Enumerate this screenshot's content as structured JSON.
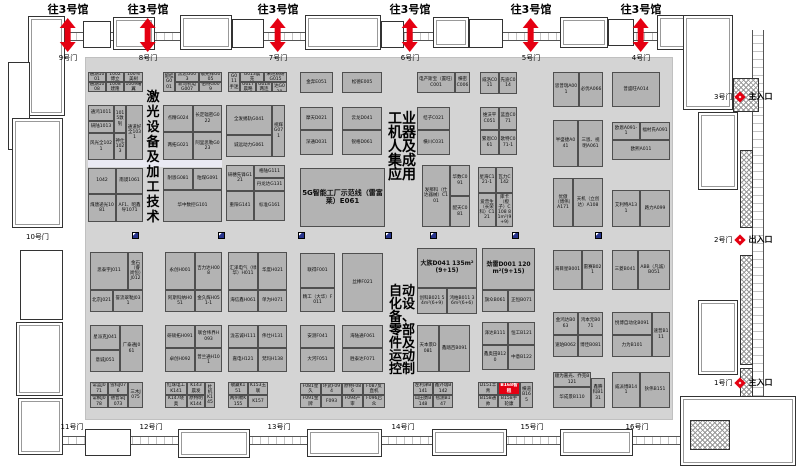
{
  "colors": {
    "hall_bg": "#d4d4d4",
    "booth_bg": "#b3b3b3",
    "booth_border": "#4f4f4f",
    "red": "#e50012",
    "icon_blue": "#27348b"
  },
  "labels": {
    "to_hall3": "往3号馆"
  },
  "top_gates": [
    {
      "label": "9号门",
      "x": 68
    },
    {
      "label": "8号门",
      "x": 148
    },
    {
      "label": "7号门",
      "x": 278
    },
    {
      "label": "6号门",
      "x": 410
    },
    {
      "label": "5号门",
      "x": 531
    },
    {
      "label": "4号门",
      "x": 641
    }
  ],
  "bottom_gates": [
    {
      "label": "11号门",
      "x": 72
    },
    {
      "label": "12号门",
      "x": 151
    },
    {
      "label": "13号门",
      "x": 279
    },
    {
      "label": "14号门",
      "x": 403
    },
    {
      "label": "15号门",
      "x": 532
    },
    {
      "label": "16号门",
      "x": 637
    }
  ],
  "left_gate": {
    "label": "10号门",
    "x": 26,
    "y": 232
  },
  "right_gates": [
    {
      "label": "3号门",
      "y": 91,
      "entrance": "主入口"
    },
    {
      "label": "2号门",
      "y": 234,
      "entrance": "出入口"
    },
    {
      "label": "1号门",
      "y": 377,
      "entrance": "主入口"
    }
  ],
  "hall": {
    "zones": [
      {
        "t": "激光设备及加工技术",
        "x": 145,
        "y": 90,
        "w": 16,
        "fs": 13,
        "lh": 15
      },
      {
        "t": "工业机器人及集成应用",
        "x": 387,
        "y": 112,
        "w": 30,
        "fs": 14,
        "lh": 14
      },
      {
        "t": "自动化设备、零部件及运动控制",
        "x": 388,
        "y": 285,
        "w": 28,
        "fs": 13,
        "lh": 13
      }
    ],
    "facility_icons": {
      "y": 232,
      "x": [
        132,
        218,
        298,
        385,
        430,
        512,
        595
      ]
    },
    "booths": [
      [
        88,
        72,
        18,
        10,
        "通湖1001"
      ],
      [
        106,
        72,
        18,
        10,
        "1002博立"
      ],
      [
        124,
        72,
        19,
        10,
        "100%美树"
      ],
      [
        88,
        82,
        18,
        10,
        "通湖1008"
      ],
      [
        106,
        82,
        18,
        10,
        "1008建隆"
      ],
      [
        124,
        82,
        19,
        10,
        "1009曙翼"
      ],
      [
        163,
        72,
        12,
        20,
        "留桂G001"
      ],
      [
        175,
        72,
        24,
        10,
        "黑思G003"
      ],
      [
        199,
        72,
        23,
        10,
        "敬光拜G005"
      ],
      [
        175,
        82,
        24,
        10,
        "新马机电G007"
      ],
      [
        199,
        82,
        23,
        10,
        "伯特G009"
      ],
      [
        228,
        72,
        12,
        20,
        "G011手迷"
      ],
      [
        240,
        72,
        24,
        10,
        "G013晨充"
      ],
      [
        264,
        72,
        23,
        10,
        "来旺精研G015"
      ],
      [
        240,
        82,
        16,
        10,
        "G017晨略"
      ],
      [
        256,
        82,
        16,
        10,
        "G018两连"
      ],
      [
        272,
        82,
        15,
        10,
        "徐风达G020"
      ],
      [
        88,
        105,
        26,
        16,
        "通鸿1011"
      ],
      [
        88,
        121,
        26,
        12,
        "研陆1013"
      ],
      [
        88,
        133,
        26,
        27,
        "风光全1021"
      ],
      [
        114,
        105,
        12,
        28,
        "1015敦钊"
      ],
      [
        114,
        133,
        12,
        27,
        "神仕1023"
      ],
      [
        126,
        105,
        17,
        55,
        "通道好全1031"
      ],
      [
        163,
        105,
        30,
        27,
        "点精G024"
      ],
      [
        193,
        105,
        29,
        27,
        "长定辐密G022"
      ],
      [
        163,
        132,
        30,
        28,
        "两拓G021"
      ],
      [
        193,
        132,
        29,
        28,
        "阿里思勒G023"
      ],
      [
        226,
        105,
        46,
        30,
        "全发掦轨G041"
      ],
      [
        272,
        105,
        13,
        52,
        "视辉G071"
      ],
      [
        226,
        135,
        46,
        22,
        "诚远动力G061"
      ],
      [
        88,
        168,
        28,
        26,
        "1042"
      ],
      [
        116,
        168,
        27,
        26,
        "南谟1061"
      ],
      [
        88,
        194,
        28,
        28,
        "煤唐递光1081"
      ],
      [
        116,
        194,
        27,
        28,
        "AF1、昭鑫导1071"
      ],
      [
        163,
        168,
        30,
        22,
        "耐恩G081"
      ],
      [
        193,
        168,
        29,
        22,
        "粕煤G091"
      ],
      [
        163,
        190,
        59,
        32,
        "华中数控G101"
      ],
      [
        226,
        165,
        28,
        26,
        "研穗先锋G121"
      ],
      [
        254,
        165,
        31,
        13,
        "格陆G111"
      ],
      [
        254,
        178,
        31,
        13,
        "丹龙达G131"
      ],
      [
        226,
        191,
        28,
        30,
        "重阳G141"
      ],
      [
        254,
        191,
        31,
        30,
        "标准G161"
      ],
      [
        300,
        72,
        33,
        21,
        "金奔E051"
      ],
      [
        342,
        72,
        40,
        21,
        "松德E005"
      ],
      [
        300,
        107,
        33,
        23,
        "摩天D021"
      ],
      [
        300,
        130,
        33,
        25,
        "深通D031"
      ],
      [
        342,
        107,
        40,
        23,
        "云龙D041"
      ],
      [
        342,
        130,
        40,
        25,
        "锐格D061"
      ],
      [
        300,
        168,
        85,
        59,
        "5G智能工厂示范线（雷富莱）E061",
        7
      ],
      [
        417,
        72,
        38,
        21,
        "电产斯宝（置旺）C001"
      ],
      [
        455,
        72,
        15,
        21,
        "横密C006"
      ],
      [
        480,
        72,
        19,
        22,
        "威洛C011"
      ],
      [
        499,
        72,
        18,
        22,
        "先迪C014"
      ],
      [
        417,
        107,
        33,
        23,
        "桔子C021"
      ],
      [
        417,
        130,
        33,
        25,
        "横川C031"
      ],
      [
        480,
        107,
        19,
        23,
        "维沃平C051"
      ],
      [
        499,
        107,
        18,
        23,
        "蓝直C071"
      ],
      [
        480,
        130,
        19,
        25,
        "繁恩C061"
      ],
      [
        499,
        130,
        18,
        25,
        "歌特C071-1"
      ],
      [
        422,
        165,
        28,
        62,
        "发那科（仕达器械）C101"
      ],
      [
        450,
        165,
        20,
        31,
        "华数C091"
      ],
      [
        450,
        196,
        20,
        31,
        "配天C081"
      ],
      [
        478,
        167,
        18,
        26,
        "星海C121-1"
      ],
      [
        496,
        167,
        17,
        26,
        "瓦力C142"
      ],
      [
        478,
        193,
        18,
        34,
        "爱普生（长荣科）C121"
      ],
      [
        496,
        193,
        17,
        34,
        "库卡（橙子）C108 81m²(9+9)"
      ],
      [
        553,
        72,
        26,
        35,
        "思普瑞A001"
      ],
      [
        579,
        72,
        24,
        35,
        "必优A066"
      ],
      [
        612,
        72,
        48,
        35,
        "普盛旺A014"
      ],
      [
        553,
        120,
        25,
        47,
        "半盛捷A041"
      ],
      [
        578,
        120,
        25,
        47,
        "三恩、视明A061"
      ],
      [
        612,
        122,
        28,
        18,
        "欧恩A091-1"
      ],
      [
        640,
        122,
        30,
        18,
        "福村氏A091"
      ],
      [
        612,
        140,
        58,
        20,
        "欧熙A011"
      ],
      [
        553,
        178,
        20,
        49,
        "优傲（博伟）A171"
      ],
      [
        573,
        178,
        30,
        49,
        "天机（立创达）A108"
      ],
      [
        612,
        190,
        28,
        37,
        "艾利特A131"
      ],
      [
        640,
        190,
        30,
        37,
        "路力A099"
      ],
      [
        90,
        252,
        38,
        38,
        "思泰宇J011"
      ],
      [
        128,
        252,
        15,
        38,
        "金石（睿尚恒）J012"
      ],
      [
        90,
        290,
        23,
        22,
        "北京J021"
      ],
      [
        113,
        290,
        30,
        22,
        "誉流翠勒J031"
      ],
      [
        90,
        325,
        30,
        25,
        "星派克J041"
      ],
      [
        90,
        350,
        30,
        22,
        "意诚J051"
      ],
      [
        120,
        325,
        23,
        47,
        "广泰通J061"
      ],
      [
        90,
        382,
        18,
        13,
        "常蓝J071"
      ],
      [
        108,
        382,
        20,
        13,
        "雪科J076"
      ],
      [
        128,
        382,
        15,
        26,
        "三木J075"
      ],
      [
        90,
        395,
        18,
        13,
        "常枫J078"
      ],
      [
        108,
        395,
        20,
        13,
        "德普罕J073"
      ],
      [
        165,
        252,
        30,
        38,
        "永创H001"
      ],
      [
        195,
        252,
        27,
        38,
        "吉力达H008"
      ],
      [
        165,
        290,
        30,
        22,
        "阿斯科纳H051"
      ],
      [
        195,
        290,
        27,
        22,
        "金久辉H051-1"
      ],
      [
        165,
        325,
        30,
        23,
        "研硕拓H091"
      ],
      [
        195,
        325,
        27,
        23,
        "联合纬界H093"
      ],
      [
        165,
        348,
        30,
        24,
        "卓创H092"
      ],
      [
        195,
        348,
        27,
        24,
        "普兰通H101"
      ],
      [
        165,
        382,
        22,
        13,
        "红珠电工K141"
      ],
      [
        187,
        382,
        18,
        13,
        "K143晨发"
      ],
      [
        205,
        382,
        10,
        26,
        "杜机K145"
      ],
      [
        165,
        395,
        22,
        13,
        "K147晓奥"
      ],
      [
        187,
        395,
        18,
        13,
        "原特明K144"
      ],
      [
        228,
        252,
        30,
        38,
        "汇泽电气（绿华）H011"
      ],
      [
        258,
        252,
        29,
        38,
        "华度H021"
      ],
      [
        228,
        290,
        30,
        22,
        "海信鑫H061"
      ],
      [
        258,
        290,
        29,
        22,
        "单为H071"
      ],
      [
        228,
        325,
        30,
        23,
        "泷志诚H111"
      ],
      [
        258,
        325,
        29,
        23,
        "伟仕H131"
      ],
      [
        228,
        348,
        30,
        24,
        "嘉电H121"
      ],
      [
        258,
        348,
        29,
        24,
        "梵玛H138"
      ],
      [
        228,
        382,
        20,
        13,
        "敬藏K151"
      ],
      [
        248,
        382,
        20,
        13,
        "K153玉联"
      ],
      [
        228,
        395,
        20,
        13,
        "两州勒K155"
      ],
      [
        248,
        395,
        20,
        13,
        "K157"
      ],
      [
        300,
        253,
        35,
        35,
        "联得F001"
      ],
      [
        300,
        288,
        35,
        24,
        "精工（大华）F011"
      ],
      [
        342,
        253,
        41,
        59,
        "丝棒F021"
      ],
      [
        300,
        325,
        35,
        23,
        "安测F041"
      ],
      [
        300,
        348,
        35,
        24,
        "大河F051"
      ],
      [
        342,
        325,
        41,
        23,
        "海陆通F061"
      ],
      [
        342,
        348,
        41,
        24,
        "胜泰达F071"
      ],
      [
        300,
        383,
        21,
        12,
        "F081星久"
      ],
      [
        321,
        383,
        21,
        12,
        "环武F094"
      ],
      [
        342,
        383,
        21,
        12,
        "原特F086"
      ],
      [
        363,
        383,
        22,
        12,
        "F087反直机"
      ],
      [
        300,
        395,
        21,
        13,
        "F091金牌"
      ],
      [
        321,
        395,
        21,
        13,
        "F093"
      ],
      [
        342,
        395,
        21,
        13,
        "F094产审"
      ],
      [
        363,
        395,
        22,
        13,
        "F096启众"
      ],
      [
        417,
        248,
        60,
        40,
        "大族D041 135m²(9+15)",
        6
      ],
      [
        417,
        288,
        30,
        26,
        "创科B021 54m²(6+9)"
      ],
      [
        447,
        288,
        30,
        26,
        "鸿柏B011 36m²(6+6)"
      ],
      [
        482,
        248,
        53,
        42,
        "劲雷D001 120m²(9+15)",
        6
      ],
      [
        482,
        290,
        26,
        22,
        "旗众B061"
      ],
      [
        508,
        290,
        27,
        22,
        "正恒B071"
      ],
      [
        417,
        325,
        22,
        47,
        "天本景D081"
      ],
      [
        439,
        325,
        31,
        47,
        "鑫踏百B091"
      ],
      [
        482,
        322,
        26,
        23,
        "泽达B111"
      ],
      [
        508,
        322,
        27,
        23,
        "恒工B121"
      ],
      [
        482,
        345,
        26,
        25,
        "鑫奥田B120"
      ],
      [
        508,
        345,
        27,
        25,
        "中意B122"
      ],
      [
        413,
        382,
        20,
        13,
        "左利津B141"
      ],
      [
        433,
        382,
        20,
        13,
        "鑫外瑞B142"
      ],
      [
        413,
        395,
        20,
        13,
        "山田勇B148"
      ],
      [
        433,
        395,
        20,
        13,
        "毯测B147"
      ],
      [
        478,
        382,
        20,
        13,
        "D151丰青"
      ],
      [
        498,
        382,
        22,
        13,
        "B168智租",
        0,
        1
      ],
      [
        520,
        382,
        13,
        26,
        "横道B165"
      ],
      [
        478,
        395,
        20,
        13,
        "B158通帅"
      ],
      [
        498,
        395,
        22,
        13,
        "B158手轮康"
      ],
      [
        553,
        250,
        29,
        40,
        "海目星B001"
      ],
      [
        582,
        250,
        21,
        40,
        "雷赛B021"
      ],
      [
        612,
        250,
        26,
        40,
        "三菱B041"
      ],
      [
        638,
        250,
        32,
        40,
        "ABB（凡诚）B051"
      ],
      [
        553,
        312,
        25,
        23,
        "金鸿达B063"
      ],
      [
        578,
        312,
        25,
        23,
        "鸿本元B071"
      ],
      [
        553,
        335,
        25,
        22,
        "速珀B062"
      ],
      [
        578,
        335,
        25,
        22,
        "博佳B081"
      ],
      [
        612,
        312,
        40,
        23,
        "悦博自动化B091"
      ],
      [
        652,
        312,
        18,
        45,
        "速普B111"
      ],
      [
        612,
        335,
        40,
        22,
        "力为B101"
      ],
      [
        553,
        372,
        38,
        15,
        "顺为嘉光、乔克B121"
      ],
      [
        553,
        387,
        38,
        21,
        "华成景B110"
      ],
      [
        591,
        378,
        14,
        30,
        "鑫腾科B131"
      ],
      [
        612,
        372,
        28,
        36,
        "威派博B141"
      ],
      [
        640,
        372,
        30,
        36,
        "狄伟B151"
      ]
    ]
  }
}
